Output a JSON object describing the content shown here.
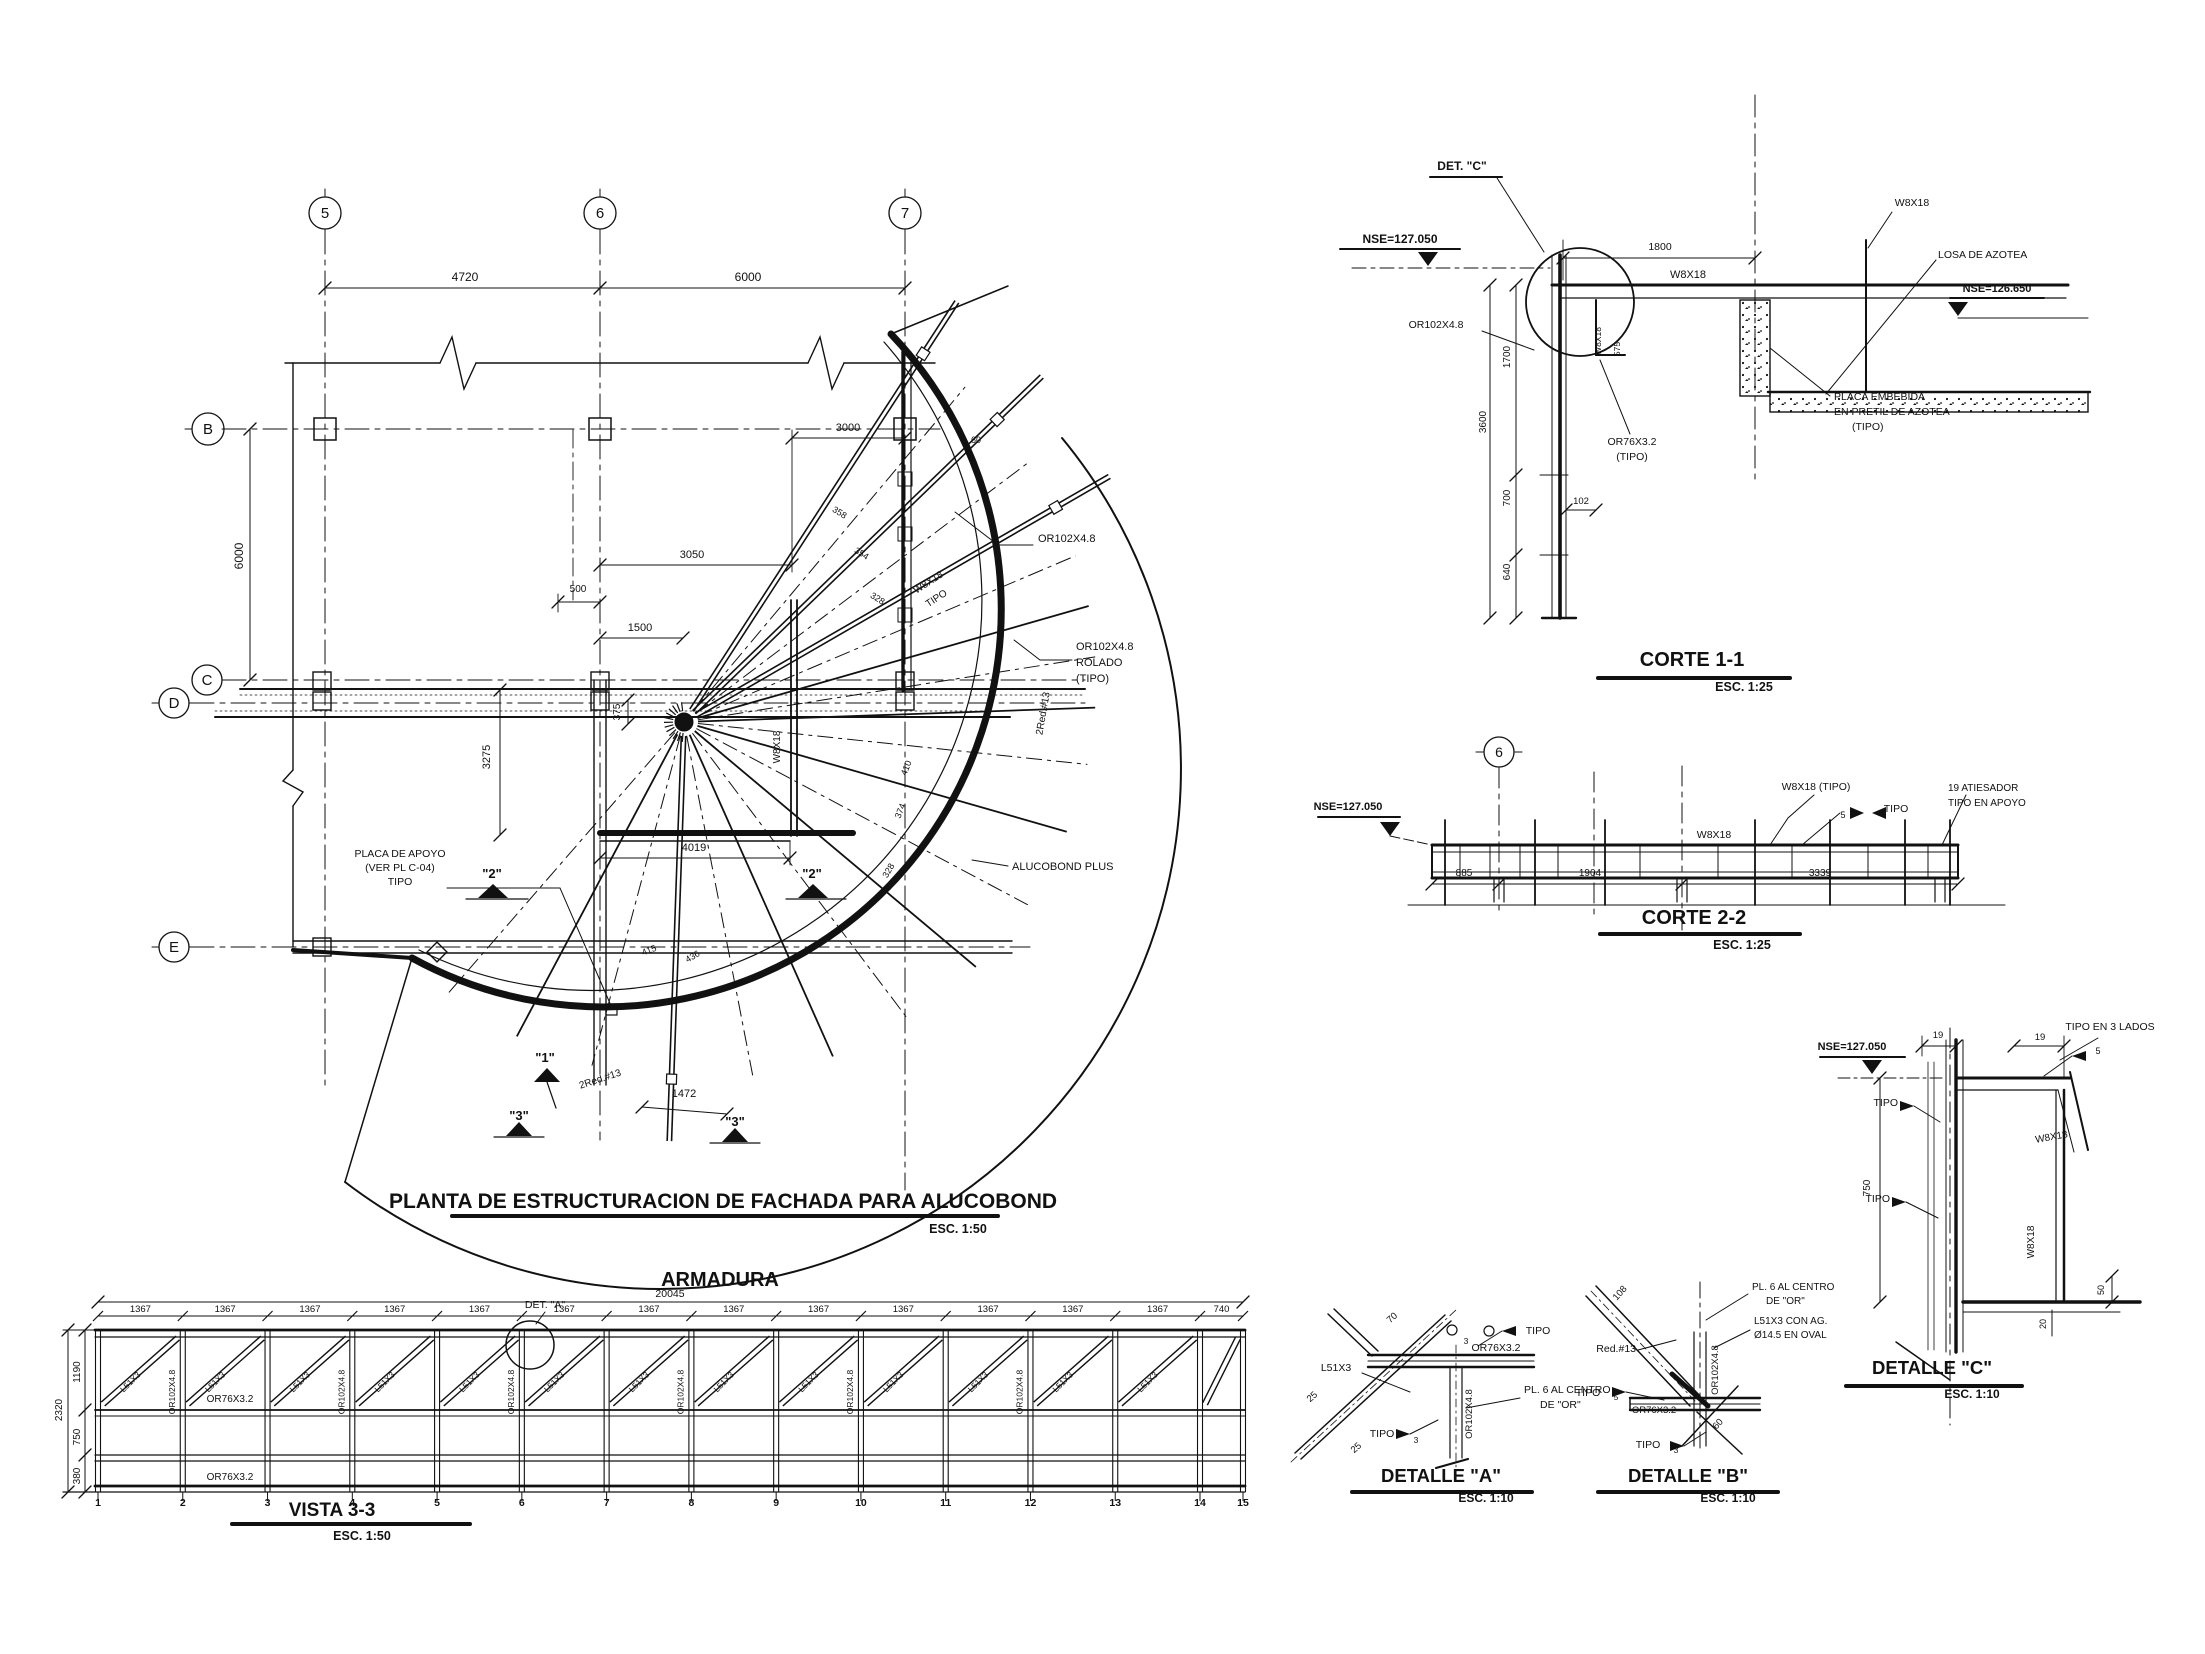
{
  "colors": {
    "ink": "#111111",
    "paper": "#ffffff"
  },
  "plan": {
    "title": "PLANTA DE ESTRUCTURACION DE FACHADA PARA ALUCOBOND",
    "scale": "ESC. 1:50",
    "grid_columns": [
      "5",
      "6",
      "7"
    ],
    "grid_rows": [
      "B",
      "C",
      "D",
      "E"
    ],
    "annotations": [
      {
        "n": "grid-bubble-5",
        "t": "5",
        "x": 325,
        "y": 218,
        "s": 15
      },
      {
        "n": "grid-bubble-6",
        "t": "6",
        "x": 600,
        "y": 218,
        "s": 15
      },
      {
        "n": "grid-bubble-7",
        "t": "7",
        "x": 905,
        "y": 218,
        "s": 15
      },
      {
        "n": "grid-bubble-B",
        "t": "B",
        "x": 208,
        "y": 434,
        "s": 15
      },
      {
        "n": "grid-bubble-C",
        "t": "C",
        "x": 207,
        "y": 685,
        "s": 15
      },
      {
        "n": "grid-bubble-D",
        "t": "D",
        "x": 174,
        "y": 708,
        "s": 15
      },
      {
        "n": "grid-bubble-E",
        "t": "E",
        "x": 174,
        "y": 952,
        "s": 15
      },
      {
        "n": "dim",
        "t": "4720",
        "x": 465,
        "y": 281,
        "s": 12
      },
      {
        "n": "dim",
        "t": "6000",
        "x": 748,
        "y": 281,
        "s": 12
      },
      {
        "n": "dim",
        "t": "6000",
        "x": 243,
        "y": 556,
        "r": -90,
        "s": 12
      },
      {
        "n": "dim",
        "t": "3000",
        "x": 848,
        "y": 431,
        "s": 11
      },
      {
        "n": "dim",
        "t": "3050",
        "x": 692,
        "y": 558,
        "s": 11
      },
      {
        "n": "dim",
        "t": "500",
        "x": 578,
        "y": 592,
        "s": 10
      },
      {
        "n": "dim",
        "t": "1500",
        "x": 640,
        "y": 631,
        "s": 11
      },
      {
        "n": "dim",
        "t": "375",
        "x": 620,
        "y": 712,
        "r": -90,
        "s": 10
      },
      {
        "n": "dim",
        "t": "3275",
        "x": 490,
        "y": 757,
        "r": -90,
        "s": 11
      },
      {
        "n": "member-label",
        "t": "OR102X4.8",
        "x": 1038,
        "y": 542,
        "s": 11,
        "a": "s"
      },
      {
        "n": "member-label",
        "t": "W8X18",
        "x": 930,
        "y": 585,
        "r": -33,
        "s": 10
      },
      {
        "n": "member-label",
        "t": "TIPO",
        "x": 938,
        "y": 601,
        "r": -33,
        "s": 10
      },
      {
        "n": "member-label",
        "t": "OR102X4.8",
        "x": 1076,
        "y": 650,
        "s": 11,
        "a": "s"
      },
      {
        "n": "member-label",
        "t": "ROLADO",
        "x": 1076,
        "y": 666,
        "s": 11,
        "a": "s"
      },
      {
        "n": "member-label",
        "t": "(TIPO)",
        "x": 1076,
        "y": 682,
        "s": 11,
        "a": "s"
      },
      {
        "n": "member-label",
        "t": "2Red.#13",
        "x": 1046,
        "y": 714,
        "r": -80,
        "s": 10
      },
      {
        "n": "member-label",
        "t": "ALUCOBOND PLUS",
        "x": 1012,
        "y": 870,
        "s": 11,
        "a": "s"
      },
      {
        "n": "note",
        "t": "PLACA DE APOYO",
        "x": 400,
        "y": 857,
        "s": 10.5
      },
      {
        "n": "note",
        "t": "(VER PL C-04)",
        "x": 400,
        "y": 871,
        "s": 10.5
      },
      {
        "n": "note",
        "t": "TIPO",
        "x": 400,
        "y": 885,
        "s": 10.5
      },
      {
        "n": "section-marker",
        "t": "\"2\"",
        "x": 492,
        "y": 878,
        "s": 13,
        "w": 1
      },
      {
        "n": "section-marker",
        "t": "\"2\"",
        "x": 812,
        "y": 878,
        "s": 13,
        "w": 1
      },
      {
        "n": "section-marker",
        "t": "\"1\"",
        "x": 545,
        "y": 1062,
        "s": 13,
        "w": 1
      },
      {
        "n": "section-marker",
        "t": "\"3\"",
        "x": 519,
        "y": 1120,
        "s": 13,
        "w": 1
      },
      {
        "n": "section-marker",
        "t": "\"3\"",
        "x": 735,
        "y": 1126,
        "s": 13,
        "w": 1
      },
      {
        "n": "member-label",
        "t": "2Red.#13",
        "x": 601,
        "y": 1082,
        "r": -18,
        "s": 10
      },
      {
        "n": "dim",
        "t": "1472",
        "x": 684,
        "y": 1097,
        "s": 11
      },
      {
        "n": "dim",
        "t": "4019",
        "x": 694,
        "y": 851,
        "s": 11
      },
      {
        "n": "member-label",
        "t": "W8X18",
        "x": 780,
        "y": 747,
        "r": -90,
        "s": 10
      },
      {
        "n": "dim",
        "t": "410",
        "x": 909,
        "y": 769,
        "r": -68,
        "s": 9
      },
      {
        "n": "dim",
        "t": "374",
        "x": 903,
        "y": 812,
        "r": -68,
        "s": 9
      },
      {
        "n": "dim",
        "t": "328",
        "x": 891,
        "y": 872,
        "r": -60,
        "s": 9
      },
      {
        "n": "dim",
        "t": "358",
        "x": 838,
        "y": 515,
        "r": 32,
        "s": 9
      },
      {
        "n": "dim",
        "t": "354",
        "x": 860,
        "y": 556,
        "r": 32,
        "s": 9
      },
      {
        "n": "dim",
        "t": "328",
        "x": 876,
        "y": 601,
        "r": 32,
        "s": 9
      },
      {
        "n": "dim",
        "t": "415",
        "x": 650,
        "y": 953,
        "r": -20,
        "s": 9
      },
      {
        "n": "dim",
        "t": "436",
        "x": 694,
        "y": 959,
        "r": -30,
        "s": 9
      },
      {
        "n": "dim",
        "t": "60",
        "x": 976,
        "y": 443,
        "s": 9
      }
    ]
  },
  "armadura": {
    "title": "ARMADURA",
    "view_title": "VISTA 3-3",
    "scale": "ESC. 1:50",
    "total_dim": "20045",
    "detail_ref": "DET. \"A\"",
    "panel_dims": [
      "1367",
      "1367",
      "1367",
      "1367",
      "1367",
      "1367",
      "1367",
      "1367",
      "1367",
      "1367",
      "1367",
      "1367",
      "1367",
      "740"
    ],
    "node_numbers": [
      "1",
      "2",
      "3",
      "4",
      "5",
      "6",
      "7",
      "8",
      "9",
      "10",
      "11",
      "12",
      "13",
      "14",
      "15"
    ],
    "diagonal_label": "L51X3",
    "vertical_label": "OR102X4.8",
    "annotations": [
      {
        "n": "dim",
        "t": "20045",
        "x": 670,
        "y": 1297,
        "s": 10.5
      },
      {
        "n": "detail-ref",
        "t": "DET. \"A\"",
        "x": 545,
        "y": 1308,
        "s": 10.5
      },
      {
        "n": "member-label",
        "t": "OR76X3.2",
        "x": 230,
        "y": 1402,
        "s": 10
      },
      {
        "n": "member-label",
        "t": "OR76X3.2",
        "x": 230,
        "y": 1480,
        "s": 10
      },
      {
        "n": "dim",
        "t": "1190",
        "x": 80,
        "y": 1372,
        "r": -90,
        "s": 10
      },
      {
        "n": "dim",
        "t": "750",
        "x": 80,
        "y": 1437,
        "r": -90,
        "s": 10
      },
      {
        "n": "dim",
        "t": "380",
        "x": 80,
        "y": 1476,
        "r": -90,
        "s": 10
      },
      {
        "n": "dim",
        "t": "2320",
        "x": 62,
        "y": 1410,
        "r": -90,
        "s": 10
      }
    ]
  },
  "corte_1_1": {
    "title": "CORTE 1-1",
    "scale": "ESC. 1:25",
    "annotations": [
      {
        "n": "detail-ref",
        "t": "DET. \"C\"",
        "x": 1462,
        "y": 170,
        "s": 12,
        "w": 1
      },
      {
        "n": "level",
        "t": "NSE=127.050",
        "x": 1400,
        "y": 243,
        "s": 12,
        "w": 1
      },
      {
        "n": "member-label",
        "t": "W8X18",
        "x": 1688,
        "y": 278,
        "s": 11
      },
      {
        "n": "member-label",
        "t": "OR102X4.8",
        "x": 1436,
        "y": 328,
        "s": 10.5
      },
      {
        "n": "member-label",
        "t": "W8X18",
        "x": 1601,
        "y": 341,
        "r": -90,
        "s": 8.5
      },
      {
        "n": "dim",
        "t": "575",
        "x": 1620,
        "y": 349,
        "r": -90,
        "s": 8.5
      },
      {
        "n": "member-label",
        "t": "OR76X3.2",
        "x": 1632,
        "y": 445,
        "s": 10.5
      },
      {
        "n": "member-label",
        "t": "(TIPO)",
        "x": 1632,
        "y": 460,
        "s": 10.5
      },
      {
        "n": "note",
        "t": "PLACA EMBEBIDA",
        "x": 1834,
        "y": 400,
        "s": 10.5,
        "a": "s"
      },
      {
        "n": "note",
        "t": "EN PRETIL DE AZOTEA",
        "x": 1834,
        "y": 415,
        "s": 10.5,
        "a": "s"
      },
      {
        "n": "note",
        "t": "(TIPO)",
        "x": 1852,
        "y": 430,
        "s": 10.5,
        "a": "s"
      },
      {
        "n": "note",
        "t": "LOSA DE AZOTEA",
        "x": 1938,
        "y": 258,
        "s": 10.5,
        "a": "s"
      },
      {
        "n": "level",
        "t": "NSE=126.650",
        "x": 1997,
        "y": 292,
        "s": 11,
        "w": 1
      },
      {
        "n": "member-label",
        "t": "W8X18",
        "x": 1912,
        "y": 206,
        "s": 10.5
      },
      {
        "n": "dim",
        "t": "1800",
        "x": 1660,
        "y": 250,
        "s": 10.5
      },
      {
        "n": "dim",
        "t": "1700",
        "x": 1510,
        "y": 357,
        "r": -90,
        "s": 10
      },
      {
        "n": "dim",
        "t": "3600",
        "x": 1486,
        "y": 422,
        "r": -90,
        "s": 10
      },
      {
        "n": "dim",
        "t": "700",
        "x": 1510,
        "y": 498,
        "r": -90,
        "s": 10
      },
      {
        "n": "dim",
        "t": "640",
        "x": 1510,
        "y": 572,
        "r": -90,
        "s": 10
      },
      {
        "n": "dim",
        "t": "102",
        "x": 1581,
        "y": 504,
        "s": 9.5
      }
    ]
  },
  "corte_2_2": {
    "title": "CORTE 2-2",
    "scale": "ESC. 1:25",
    "annotations": [
      {
        "n": "grid-bubble-6",
        "t": "6",
        "x": 1499,
        "y": 757,
        "s": 14
      },
      {
        "n": "level",
        "t": "NSE=127.050",
        "x": 1348,
        "y": 810,
        "s": 11,
        "w": 1
      },
      {
        "n": "member-label",
        "t": "W8X18",
        "x": 1714,
        "y": 838,
        "s": 10.5
      },
      {
        "n": "member-label",
        "t": "W8X18 (TIPO)",
        "x": 1816,
        "y": 790,
        "s": 10.5
      },
      {
        "n": "weld-size",
        "t": "5",
        "x": 1843,
        "y": 818,
        "s": 9
      },
      {
        "n": "note",
        "t": "TIPO",
        "x": 1896,
        "y": 812,
        "s": 10.5
      },
      {
        "n": "note",
        "t": "19 ATIESADOR",
        "x": 1948,
        "y": 791,
        "s": 10,
        "a": "s"
      },
      {
        "n": "note",
        "t": "TIPO EN APOYO",
        "x": 1948,
        "y": 806,
        "s": 10,
        "a": "s"
      },
      {
        "n": "dim",
        "t": "885",
        "x": 1464,
        "y": 876,
        "s": 10
      },
      {
        "n": "dim",
        "t": "1904",
        "x": 1590,
        "y": 876,
        "s": 10
      },
      {
        "n": "dim",
        "t": "3339",
        "x": 1820,
        "y": 876,
        "s": 10
      }
    ]
  },
  "detalle_a": {
    "title": "DETALLE \"A\"",
    "scale": "ESC. 1:10",
    "annotations": [
      {
        "n": "dim",
        "t": "70",
        "x": 1394,
        "y": 1320,
        "r": -42,
        "s": 9.5
      },
      {
        "n": "weld-size",
        "t": "3",
        "x": 1466,
        "y": 1344,
        "s": 8.5
      },
      {
        "n": "note",
        "t": "TIPO",
        "x": 1538,
        "y": 1334,
        "s": 10.5
      },
      {
        "n": "member-label",
        "t": "OR76X3.2",
        "x": 1496,
        "y": 1351,
        "s": 10.5
      },
      {
        "n": "member-label",
        "t": "L51X3",
        "x": 1336,
        "y": 1371,
        "s": 10.5
      },
      {
        "n": "note",
        "t": "PL. 6 AL CENTRO",
        "x": 1524,
        "y": 1393,
        "s": 10.5,
        "a": "s"
      },
      {
        "n": "note",
        "t": "DE \"OR\"",
        "x": 1540,
        "y": 1408,
        "s": 10.5,
        "a": "s"
      },
      {
        "n": "member-label",
        "t": "OR102X4.8",
        "x": 1472,
        "y": 1414,
        "r": -90,
        "s": 9.5
      },
      {
        "n": "note",
        "t": "TIPO",
        "x": 1382,
        "y": 1437,
        "s": 10.5
      },
      {
        "n": "weld-size",
        "t": "3",
        "x": 1416,
        "y": 1443,
        "s": 8.5
      },
      {
        "n": "dim",
        "t": "25",
        "x": 1314,
        "y": 1399,
        "r": -42,
        "s": 9.5
      },
      {
        "n": "dim",
        "t": "25",
        "x": 1358,
        "y": 1450,
        "r": -42,
        "s": 9.5
      }
    ]
  },
  "detalle_b": {
    "title": "DETALLE \"B\"",
    "scale": "ESC. 1:10",
    "annotations": [
      {
        "n": "dim",
        "t": "108",
        "x": 1622,
        "y": 1295,
        "r": -48,
        "s": 9.5
      },
      {
        "n": "note",
        "t": "PL. 6 AL CENTRO",
        "x": 1752,
        "y": 1290,
        "s": 10,
        "a": "s"
      },
      {
        "n": "note",
        "t": "DE \"OR\"",
        "x": 1766,
        "y": 1304,
        "s": 10,
        "a": "s"
      },
      {
        "n": "note",
        "t": "L51X3 CON AG.",
        "x": 1754,
        "y": 1324,
        "s": 10,
        "a": "s"
      },
      {
        "n": "note",
        "t": "Ø14.5 EN OVAL",
        "x": 1754,
        "y": 1338,
        "s": 10,
        "a": "s"
      },
      {
        "n": "member-label",
        "t": "Red.#13",
        "x": 1636,
        "y": 1352,
        "s": 10.5,
        "a": "e"
      },
      {
        "n": "member-label",
        "t": "OR102X4.8",
        "x": 1718,
        "y": 1370,
        "r": -90,
        "s": 9.5
      },
      {
        "n": "note",
        "t": "TIPO",
        "x": 1588,
        "y": 1396,
        "s": 10.5
      },
      {
        "n": "weld-size",
        "t": "5",
        "x": 1616,
        "y": 1400,
        "s": 8.5
      },
      {
        "n": "member-label",
        "t": "OR76X3.2",
        "x": 1654,
        "y": 1413,
        "s": 9.5
      },
      {
        "n": "dim",
        "t": "60",
        "x": 1720,
        "y": 1426,
        "r": -48,
        "s": 9.5
      },
      {
        "n": "note",
        "t": "TIPO",
        "x": 1648,
        "y": 1448,
        "s": 10.5
      },
      {
        "n": "weld-size",
        "t": "3",
        "x": 1676,
        "y": 1453,
        "s": 8.5
      }
    ]
  },
  "detalle_c": {
    "title": "DETALLE \"C\"",
    "scale": "ESC. 1:10",
    "annotations": [
      {
        "n": "level",
        "t": "NSE=127.050",
        "x": 1852,
        "y": 1050,
        "s": 11,
        "w": 1
      },
      {
        "n": "dim",
        "t": "19",
        "x": 1938,
        "y": 1038,
        "s": 9.5
      },
      {
        "n": "dim",
        "t": "19",
        "x": 2040,
        "y": 1040,
        "s": 9.5
      },
      {
        "n": "note",
        "t": "TIPO EN 3 LADOS",
        "x": 2110,
        "y": 1030,
        "s": 10.5
      },
      {
        "n": "weld-size",
        "t": "5",
        "x": 2098,
        "y": 1054,
        "s": 9
      },
      {
        "n": "note",
        "t": "TIPO",
        "x": 1898,
        "y": 1106,
        "s": 10.5,
        "a": "e"
      },
      {
        "n": "note",
        "t": "TIPO",
        "x": 1890,
        "y": 1202,
        "s": 10.5,
        "a": "e"
      },
      {
        "n": "member-label",
        "t": "W8X18",
        "x": 2052,
        "y": 1140,
        "r": -10,
        "s": 10
      },
      {
        "n": "member-label",
        "t": "W8X18",
        "x": 2034,
        "y": 1242,
        "r": -90,
        "s": 10
      },
      {
        "n": "dim",
        "t": "750",
        "x": 1870,
        "y": 1188,
        "r": -90,
        "s": 10
      },
      {
        "n": "dim",
        "t": "50",
        "x": 2104,
        "y": 1290,
        "r": -90,
        "s": 9
      },
      {
        "n": "dim",
        "t": "20",
        "x": 2046,
        "y": 1324,
        "r": -90,
        "s": 9
      }
    ]
  }
}
